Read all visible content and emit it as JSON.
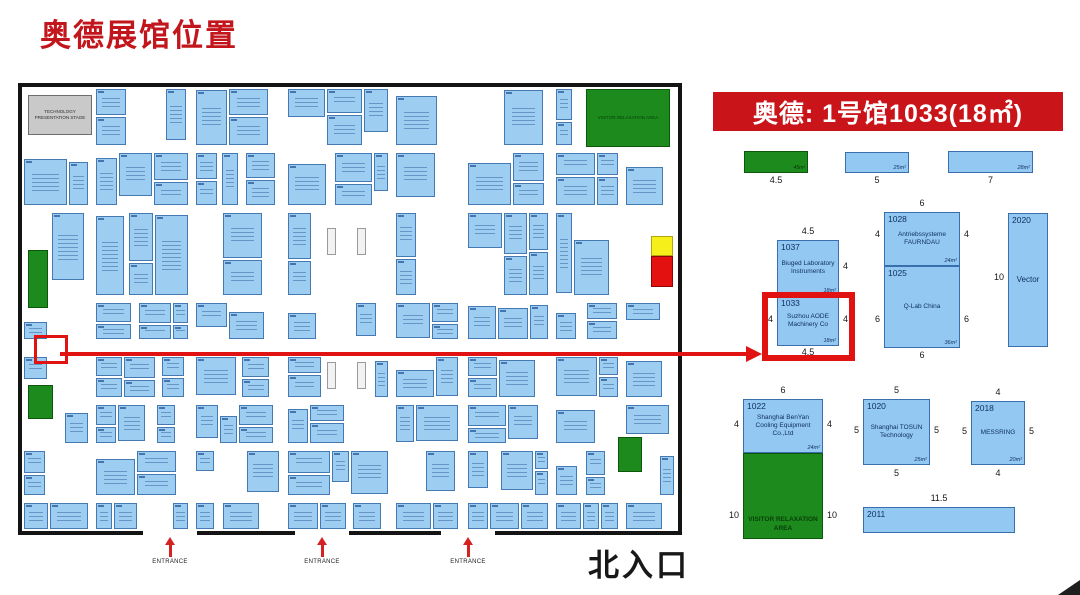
{
  "page": {
    "title": "奥德展馆位置"
  },
  "banner": {
    "text": "奥德: 1号馆1033(18㎡)"
  },
  "colors": {
    "accent_red": "#c9141a",
    "alert_red": "#e01212",
    "booth_blue": "#9ecdf2",
    "booth_border": "#4579b2",
    "map_green": "#1d8a1d",
    "booth_text": "#0e2e5c"
  },
  "floor_plan": {
    "stage_label": "TECHNOLOGY PRESENTATION STAGE",
    "relaxation_label": "VISITOR RELAXATION AREA",
    "entrances": [
      "ENTRANCE",
      "ENTRANCE",
      "ENTRANCE"
    ],
    "north_entrance": "北入口"
  },
  "detail": {
    "top_row": [
      {
        "type": "green",
        "area": "45m²",
        "width": "4.5"
      },
      {
        "type": "blue",
        "area": "25m²",
        "width": "5"
      },
      {
        "type": "blue",
        "area": "28m²",
        "width": "7"
      }
    ],
    "booths": [
      {
        "id": "1037",
        "name": "Biuged Laboratory Instruments",
        "top": "4.5",
        "right": "4",
        "area": "18m²"
      },
      {
        "id": "1033",
        "name": "Suzhou AODE Machinery Co",
        "left": "4",
        "right": "4",
        "bottom": "4.5",
        "area": "18m²",
        "highlighted": true
      },
      {
        "id": "1028",
        "name": "Antriebssysteme FAURNDAU",
        "top": "6",
        "left": "4",
        "right": "4",
        "area": "24m²"
      },
      {
        "id": "1025",
        "name": "Q-Lab China",
        "left": "6",
        "right": "6",
        "bottom": "6",
        "area": "36m²"
      },
      {
        "id": "2020",
        "name": "Vector",
        "left": "10"
      },
      {
        "id": "1022",
        "name": "Shanghai BenYan Cooling Equipment Co.,Ltd",
        "top": "6",
        "left": "4",
        "right": "4",
        "area": "24m²"
      },
      {
        "id": "1020",
        "name": "Shanghai TOSUN Technology",
        "top": "5",
        "left": "5",
        "right": "5",
        "bottom": "5",
        "area": "25m²"
      },
      {
        "id": "2018",
        "name": "MESSRING",
        "top": "4",
        "left": "5",
        "right": "5",
        "bottom": "4",
        "area": "20m²"
      },
      {
        "id": "2011",
        "name": "",
        "top": "11.5"
      }
    ],
    "visitor_area": {
      "label": "VISITOR RELAXATION AREA",
      "left": "10",
      "right": "10"
    }
  }
}
